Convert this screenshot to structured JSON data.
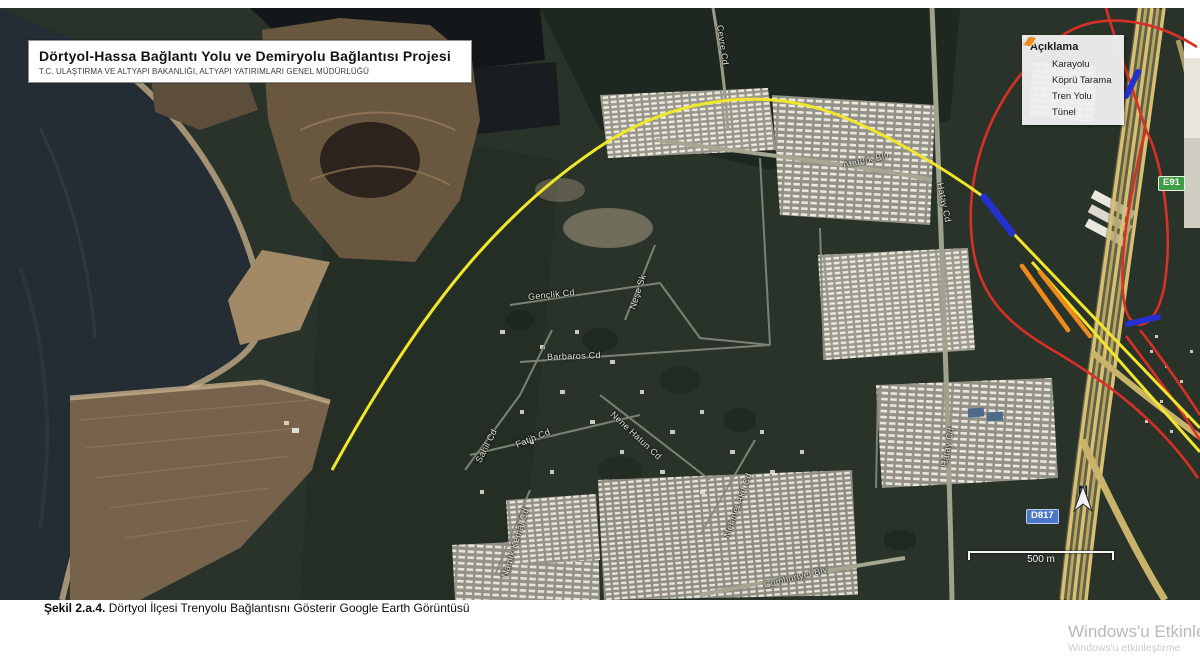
{
  "title_box": {
    "title": "Dörtyol-Hassa Bağlantı Yolu ve Demiryolu Bağlantısı Projesi",
    "subtitle": "T.C. ULAŞTIRMA VE ALTYAPI BAKANLIĞI, ALTYAPI YATIRIMLARI GENEL MÜDÜRLÜĞÜ"
  },
  "legend": {
    "title": "Açıklama",
    "items": [
      {
        "label": "Karayolu",
        "color": "#d93025",
        "style": "dashes"
      },
      {
        "label": "Köprü Tarama",
        "color": "#2431d0",
        "style": "polygon"
      },
      {
        "label": "Tren Yolu",
        "color": "#efe23a",
        "style": "dashes"
      },
      {
        "label": "Tünel",
        "color": "#ef8b1d",
        "style": "polygon"
      }
    ]
  },
  "map": {
    "badges": {
      "e_road": "E91",
      "d_road": "D817"
    },
    "north_label": "N",
    "scale_bar": {
      "label": "500 m"
    },
    "street_labels": [
      {
        "text": "Atatürk Blv",
        "x": 843,
        "y": 152,
        "rot": -12
      },
      {
        "text": "Hatay Cd",
        "x": 940,
        "y": 170,
        "rot": 78
      },
      {
        "text": "Hatay Cd",
        "x": 944,
        "y": 454,
        "rot": -80
      },
      {
        "text": "Çevre Cd",
        "x": 720,
        "y": 12,
        "rot": 82
      },
      {
        "text": "Gençlik Cd",
        "x": 528,
        "y": 284,
        "rot": -6
      },
      {
        "text": "Neşe Sk",
        "x": 632,
        "y": 296,
        "rot": -72
      },
      {
        "text": "Barbaros Cd",
        "x": 547,
        "y": 344,
        "rot": -2
      },
      {
        "text": "Sahil Cd",
        "x": 478,
        "y": 449,
        "rot": -63
      },
      {
        "text": "Fatih Cd",
        "x": 516,
        "y": 432,
        "rot": -22
      },
      {
        "text": "Nene Hatun Cd",
        "x": 612,
        "y": 400,
        "rot": 43
      },
      {
        "text": "Mehmet Akif Cd",
        "x": 726,
        "y": 524,
        "rot": -70
      },
      {
        "text": "Namık Kemal Cd",
        "x": 504,
        "y": 564,
        "rot": -72
      },
      {
        "text": "Cumhuriyet Blv",
        "x": 764,
        "y": 572,
        "rot": -14
      }
    ]
  },
  "caption": {
    "figure": "Şekil 2.a.4.",
    "text": " Dörtyol İlçesi Trenyolu Bağlantısnı Gösterir Google Earth Görüntüsü"
  },
  "watermark": {
    "line1": "Windows'u Etkinle",
    "line2": "Windows'u etkinleştirme"
  },
  "colors": {
    "karayolu": "#d93025",
    "tren_yolu": "#f0e62a",
    "kopru": "#2431d0",
    "tunel": "#ef8b1d"
  }
}
